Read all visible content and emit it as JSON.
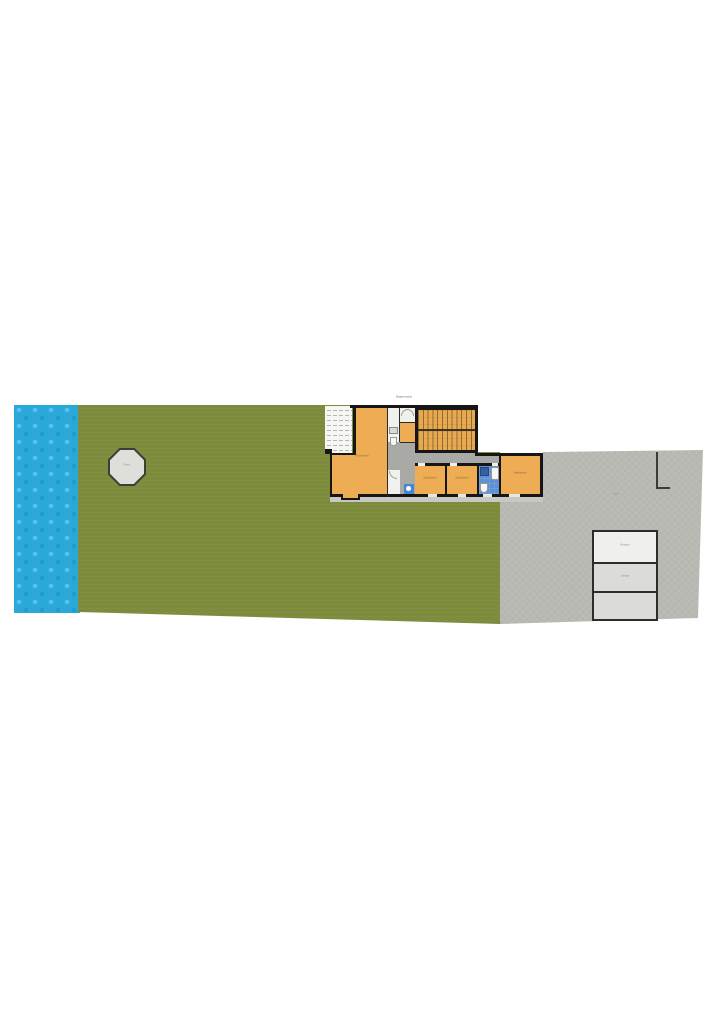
{
  "plan": {
    "top_label": "Begane grond",
    "water": {
      "color": "#2aa8da"
    },
    "garden": {
      "color": "#7d8c3c"
    },
    "driveway": {
      "label": "Oprit",
      "color": "#b9b9b3"
    },
    "gazebo": {
      "label": "Prieel"
    },
    "house": {
      "wall_color": "#161616",
      "room_color": "#eeac55",
      "bathroom_color": "#5c8fd3",
      "veranda_color": "#e9a94f",
      "rooms": {
        "living": {
          "label": "Woonkamer"
        },
        "bedroom1": {
          "label": "Slaapkamer"
        },
        "bedroom2": {
          "label": "Slaapkamer"
        },
        "bedroom3": {
          "label": "Slaapkamer"
        }
      }
    },
    "outbuilding": {
      "rooms": [
        {
          "label": "Berging"
        },
        {
          "label": "Garage"
        },
        {
          "label": ""
        }
      ]
    }
  }
}
